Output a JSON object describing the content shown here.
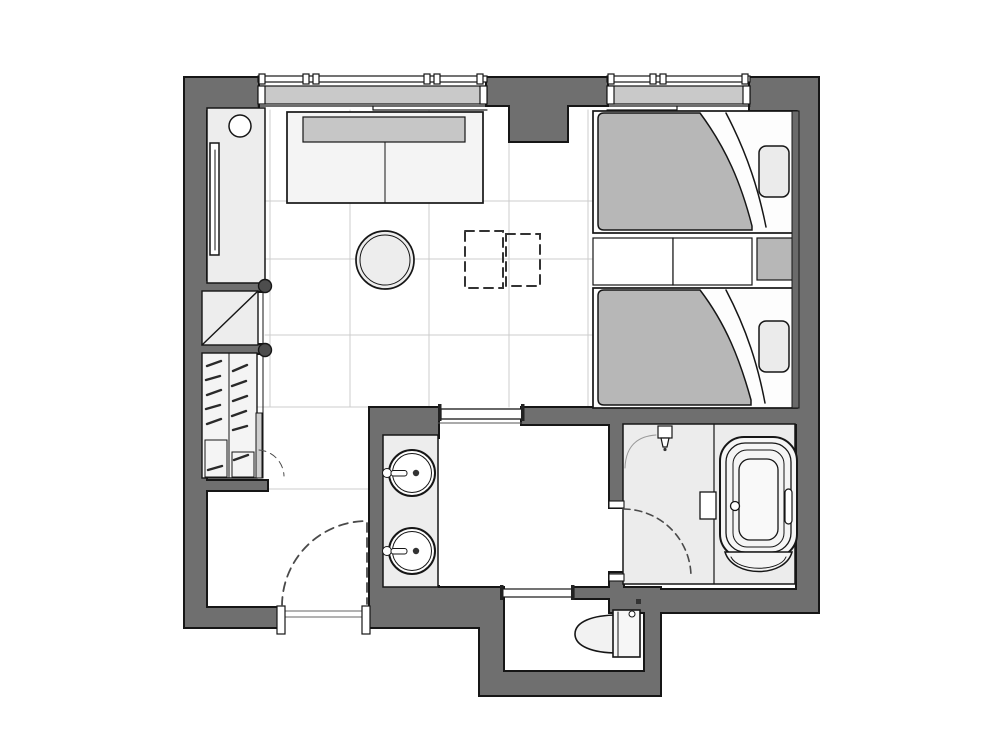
{
  "meta": {
    "type": "architectural-floor-plan",
    "view": "top-down",
    "text_labels": []
  },
  "colors": {
    "wall": "#6f6f6f",
    "outline": "#161616",
    "furniture_light": "#ededed",
    "fabric_gray": "#b7b7b7",
    "cushion_gray": "#c6c6c6",
    "glazing": "#c9c9c9",
    "wet_floor": "#ececec",
    "floor_line": "#cccccc",
    "panel_gray": "#cfcfcf",
    "headboard": "#6a6a6a",
    "pillow": "#ebebeb",
    "door_dash": "#4a4a4a",
    "threshold_line": "#666666",
    "white": "#ffffff"
  },
  "rooms": [
    {
      "name": "living-bedroom"
    },
    {
      "name": "corridor"
    },
    {
      "name": "entry"
    },
    {
      "name": "powder-room"
    },
    {
      "name": "wet-room-bath"
    },
    {
      "name": "toilet-room"
    },
    {
      "name": "wardrobe-closet"
    }
  ],
  "furniture": [
    {
      "name": "sofa"
    },
    {
      "name": "round-side-table"
    },
    {
      "name": "folding-tables-dashed"
    },
    {
      "name": "tv-console"
    },
    {
      "name": "wall-tv"
    },
    {
      "name": "console-lamp"
    },
    {
      "name": "luggage-bench"
    },
    {
      "name": "wardrobe-hangers"
    },
    {
      "name": "twin-bed-top"
    },
    {
      "name": "twin-bed-bottom"
    },
    {
      "name": "pillow"
    },
    {
      "name": "nightstand"
    },
    {
      "name": "bedside-shelf"
    },
    {
      "name": "headboard-panel"
    },
    {
      "name": "double-sink-vanity"
    },
    {
      "name": "bathtub"
    },
    {
      "name": "shower-head"
    },
    {
      "name": "toilet"
    },
    {
      "name": "window"
    },
    {
      "name": "entry-door"
    },
    {
      "name": "bath-door"
    },
    {
      "name": "sliding-door"
    }
  ]
}
